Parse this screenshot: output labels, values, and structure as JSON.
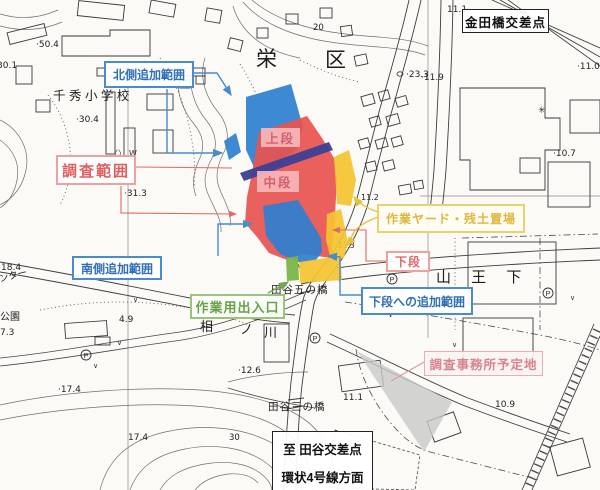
{
  "callouts": {
    "kanedabashi": "金田橋交差点",
    "north_add": "北側追加範囲",
    "survey_range": "調査範囲",
    "south_add": "南側追加範囲",
    "work_yard": "作業ヤード・残土置場",
    "lower_tier": "下段",
    "lower_tier_add": "下段への追加範囲",
    "work_entrance": "作業用出入口",
    "office_site": "調査事務所予定地",
    "destination_line1": "至 田谷交差点",
    "destination_line2": "環状4号線方面"
  },
  "tiers": {
    "upper": "上段",
    "middle": "中段"
  },
  "map": {
    "ward_char1": "栄",
    "ward_char2": "区",
    "school": "千 秀 小 学 校",
    "sannoshita": "山 王 下",
    "river_char1": "相",
    "river_char2": "ノ",
    "river_char3": "川",
    "bridge_upper": "田谷五の橋",
    "bridge_lower": "田谷三の橋",
    "park_partial": "公園",
    "center_partial": "ンター",
    "parking_symbol": "P",
    "factory_symbol": "✳",
    "grass_symbol": "∨",
    "gate_symbol": "〈〉",
    "well_symbol": "W",
    "elevations": [
      "·50.4",
      "30.1",
      "·30.4",
      "·31.3",
      "·23.3",
      "11.1",
      "·11.9",
      "·11.0",
      "·10.7",
      "11.3",
      "4.9",
      "18.4",
      "7.3",
      "·17.4",
      "17.4",
      "·12.6",
      "30",
      "10.9",
      "11.1",
      "20",
      "11.2"
    ]
  },
  "colors": {
    "overlay_blue": "#2e7fd0",
    "overlay_red": "#e8534e",
    "overlay_navy": "#3c3f96",
    "overlay_yellow": "#f3c430",
    "overlay_green": "#7ab648",
    "overlay_gray": "#c9c9c9",
    "leader_blue": "#4a8bc9",
    "leader_red": "#e06a64",
    "leader_yellow": "#e6c13d",
    "leader_green": "#74a850",
    "leader_pink": "#dc9aa0"
  }
}
